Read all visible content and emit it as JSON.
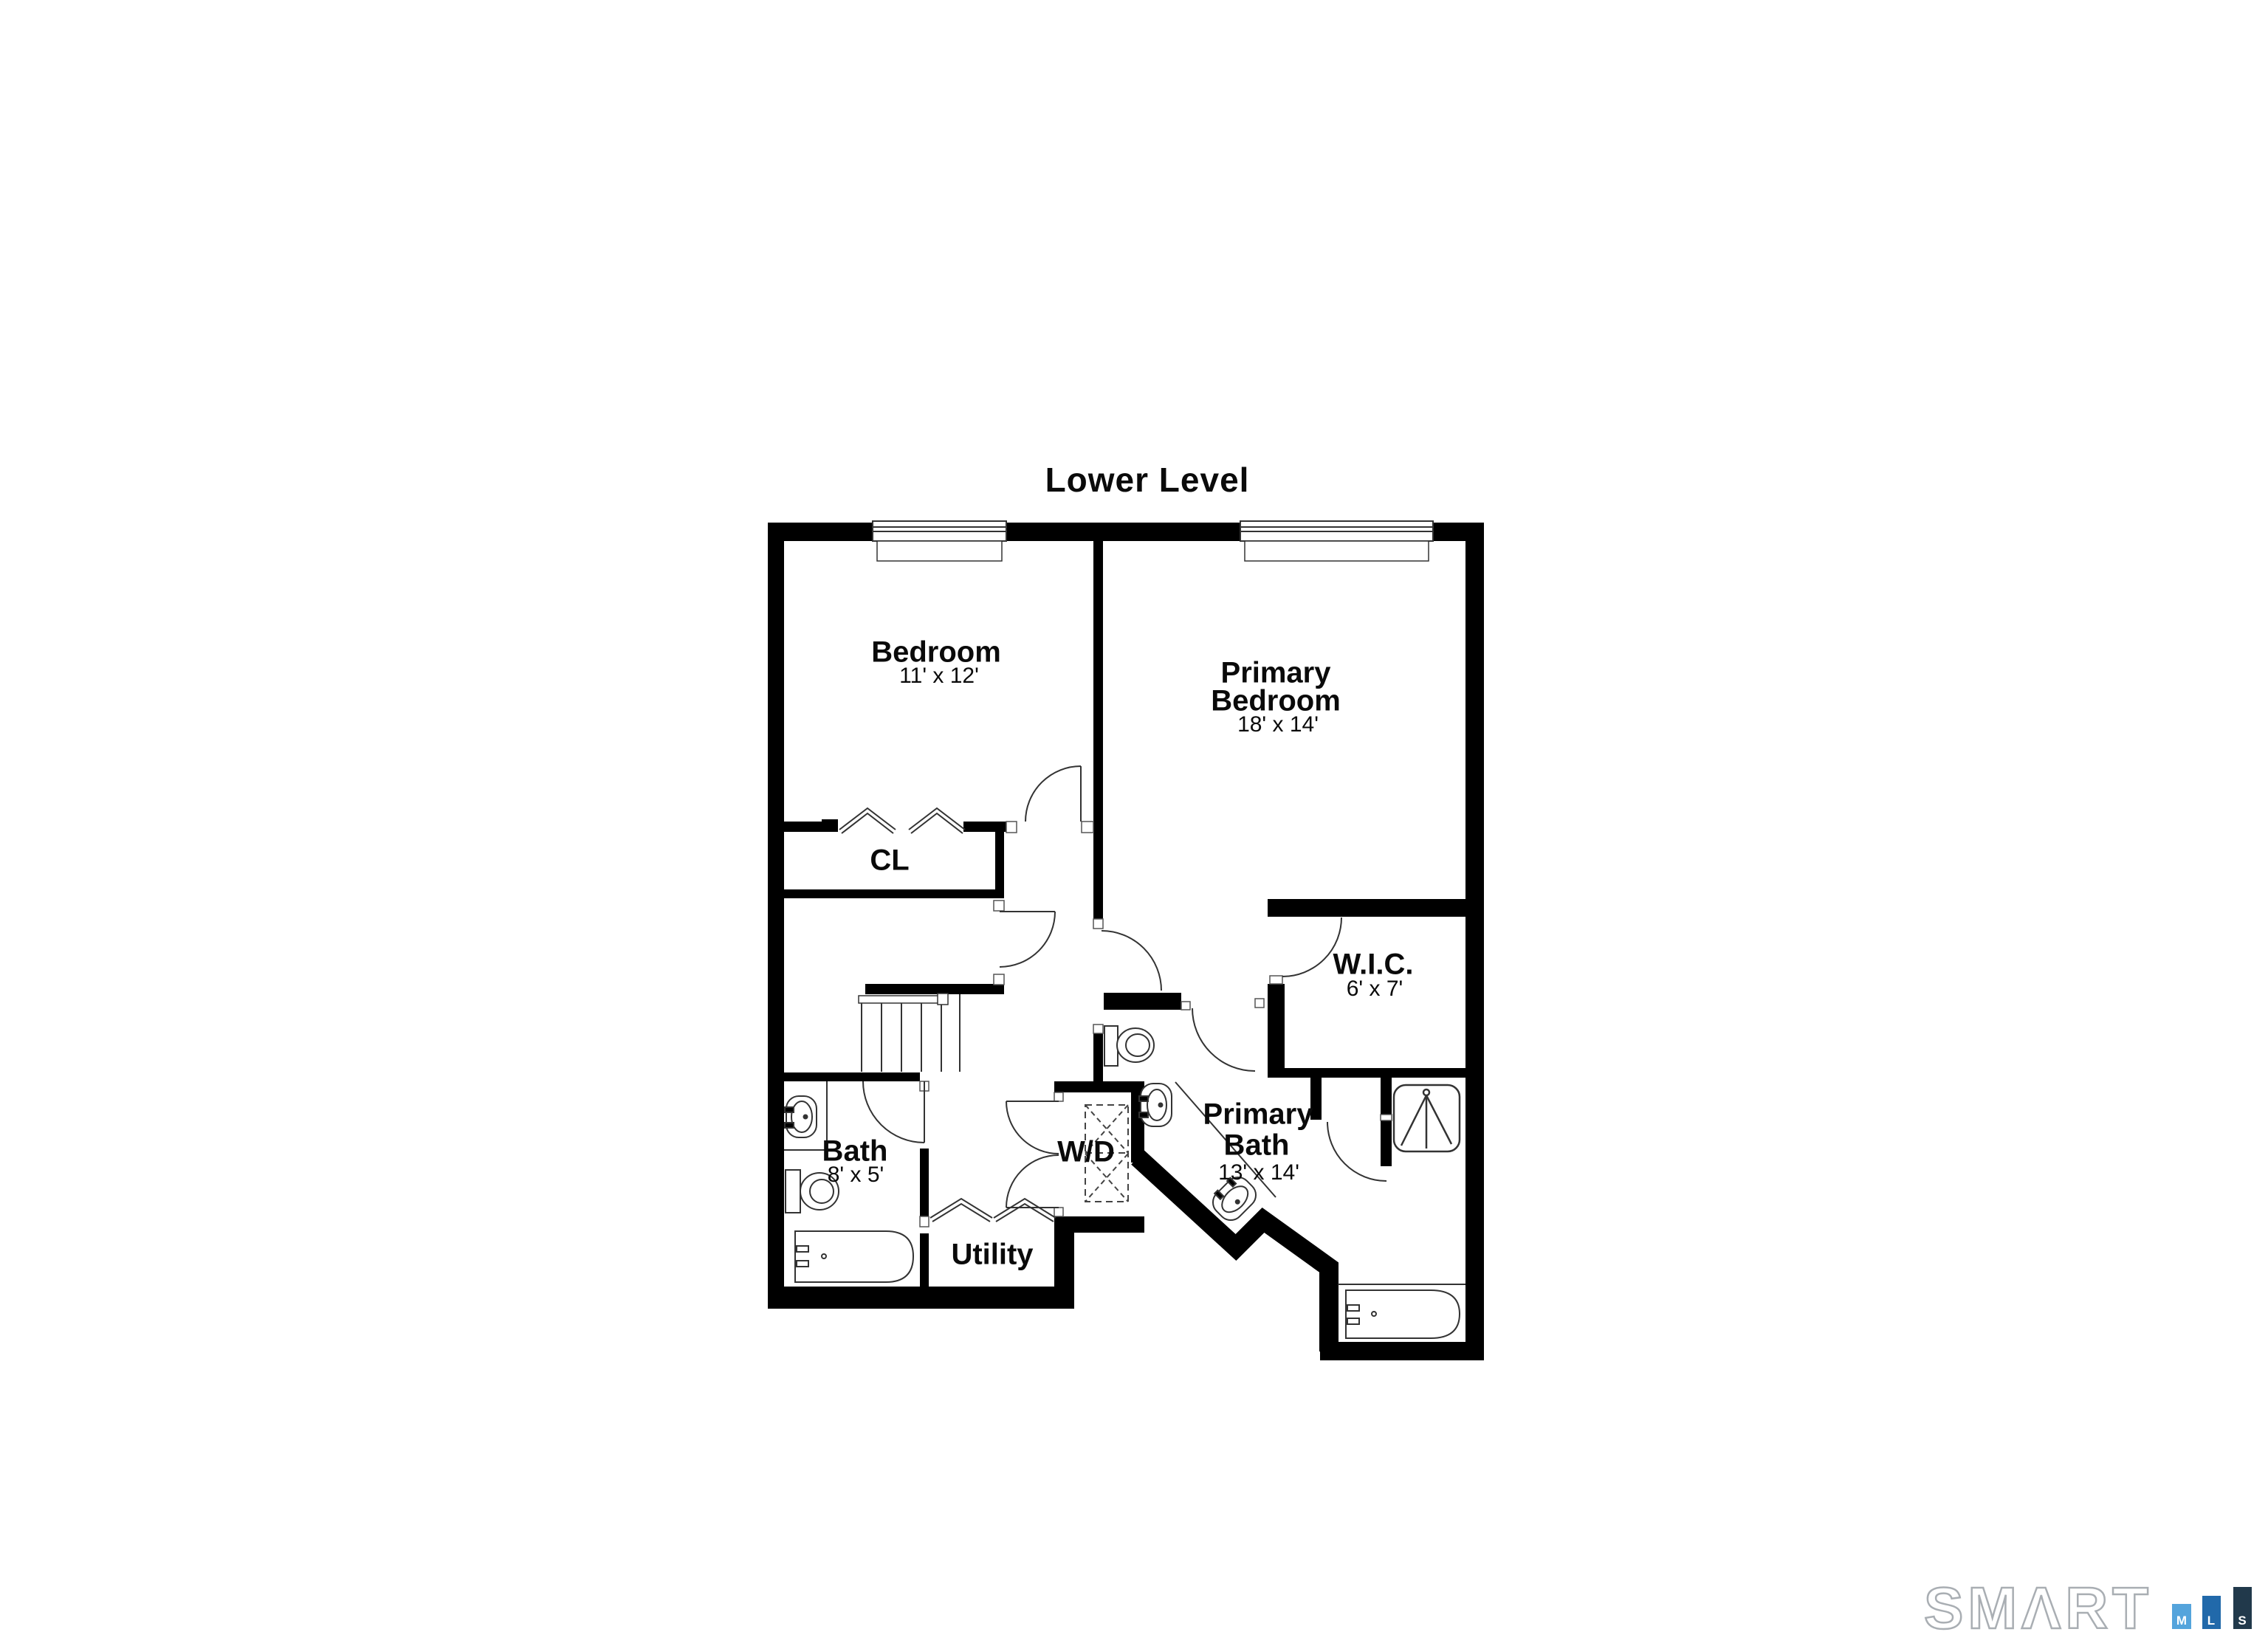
{
  "title": "Lower Level",
  "rooms": [
    {
      "id": "bedroom",
      "name": "Bedroom",
      "dims": "11' x 12'"
    },
    {
      "id": "primary-bedroom",
      "lines": [
        "Primary",
        "Bedroom"
      ],
      "dims": "18' x 14'"
    },
    {
      "id": "closet",
      "name": "CL"
    },
    {
      "id": "wic",
      "name": "W.I.C.",
      "dims": "6' x 7'"
    },
    {
      "id": "primary-bath",
      "lines": [
        "Primary",
        "Bath"
      ],
      "dims": "13' x 14'"
    },
    {
      "id": "bath",
      "name": "Bath",
      "dims": "8' x 5'"
    },
    {
      "id": "washer-dryer",
      "name": "W/D"
    },
    {
      "id": "utility",
      "name": "Utility"
    }
  ],
  "logo": {
    "brand": "SMΛRT",
    "brand_outline_color": "#a9aeb3",
    "bars": [
      {
        "letter": "M",
        "color": "#54a4dc"
      },
      {
        "letter": "L",
        "color": "#2169aa"
      },
      {
        "letter": "S",
        "color": "#21394b"
      }
    ]
  },
  "colors": {
    "wall": "#000000",
    "line": "#333333"
  }
}
